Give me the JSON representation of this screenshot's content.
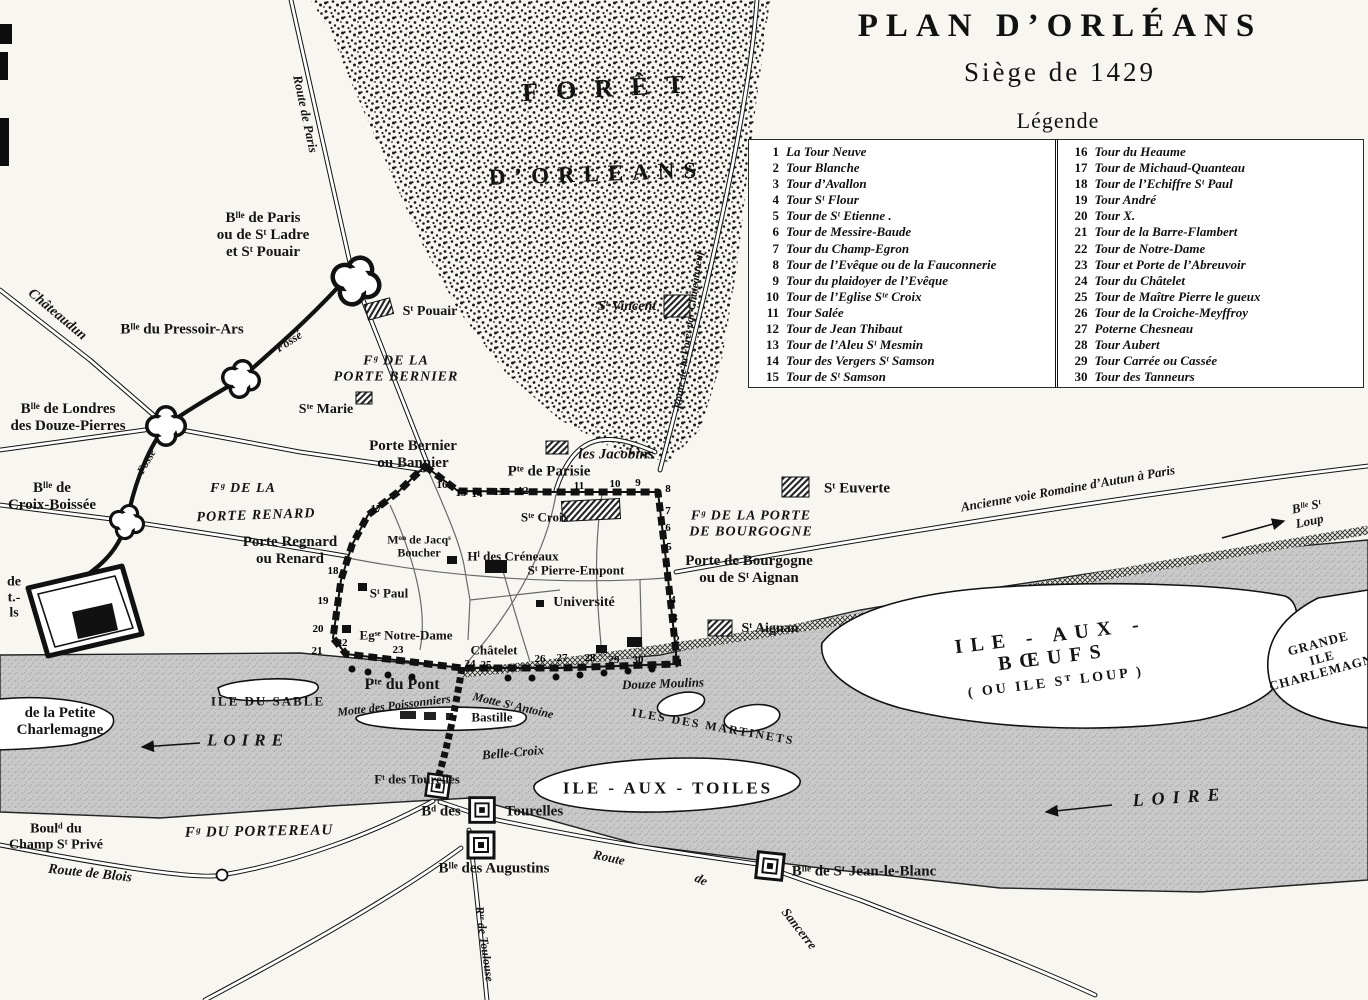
{
  "title": {
    "line1": "PLAN D’ORLÉANS",
    "line2": "Siège  de  1429"
  },
  "legend": {
    "heading": "Légende",
    "items": [
      {
        "n": 1,
        "label": "La Tour Neuve"
      },
      {
        "n": 2,
        "label": "Tour Blanche"
      },
      {
        "n": 3,
        "label": "Tour d’Avallon"
      },
      {
        "n": 4,
        "label": "Tour Sᵗ Flour"
      },
      {
        "n": 5,
        "label": "Tour de Sᵗ Etienne ."
      },
      {
        "n": 6,
        "label": "Tour de Messire-Baude"
      },
      {
        "n": 7,
        "label": "Tour du Champ-Egron"
      },
      {
        "n": 8,
        "label": "Tour de l’Evêque ou de la Fauconnerie"
      },
      {
        "n": 9,
        "label": "Tour du plaidoyer de l’Evêque"
      },
      {
        "n": 10,
        "label": "Tour de l’Eglise Sᵗᵉ Croix"
      },
      {
        "n": 11,
        "label": "Tour Salée"
      },
      {
        "n": 12,
        "label": "Tour de Jean Thibaut"
      },
      {
        "n": 13,
        "label": "Tour de l’Aleu Sᵗ Mesmin"
      },
      {
        "n": 14,
        "label": "Tour des Vergers Sᵗ Samson"
      },
      {
        "n": 15,
        "label": "Tour de Sᵗ Samson"
      },
      {
        "n": 16,
        "label": "Tour du Heaume"
      },
      {
        "n": 17,
        "label": "Tour de Michaud-Quanteau"
      },
      {
        "n": 18,
        "label": "Tour de l’Echiffre Sᵗ Paul"
      },
      {
        "n": 19,
        "label": "Tour André"
      },
      {
        "n": 20,
        "label": "Tour X."
      },
      {
        "n": 21,
        "label": "Tour de la Barre-Flambert"
      },
      {
        "n": 22,
        "label": "Tour de Notre-Dame"
      },
      {
        "n": 23,
        "label": "Tour et Porte de l’Abreuvoir"
      },
      {
        "n": 24,
        "label": "Tour du Châtelet"
      },
      {
        "n": 25,
        "label": "Tour de Maître Pierre le gueux"
      },
      {
        "n": 26,
        "label": "Tour de la Croiche-Meyffroy"
      },
      {
        "n": 27,
        "label": "Poterne Chesneau"
      },
      {
        "n": 28,
        "label": "Tour Aubert"
      },
      {
        "n": 29,
        "label": "Tour Carrée ou Cassée"
      },
      {
        "n": 30,
        "label": "Tour des Tanneurs"
      }
    ]
  },
  "map": {
    "labels": [
      {
        "name": "foret-label-1",
        "text": "FORÊT",
        "x": 612,
        "y": 88,
        "rot": -3,
        "cls": "caps",
        "fs": 26,
        "ls": 18
      },
      {
        "name": "foret-label-2",
        "text": "D’ORLÉANS",
        "x": 597,
        "y": 174,
        "rot": -2,
        "cls": "caps",
        "fs": 23,
        "ls": 9
      },
      {
        "name": "route-de-paris-label",
        "text": "Route de Paris",
        "x": 305,
        "y": 114,
        "rot": 78,
        "cls": "it",
        "fs": 13
      },
      {
        "name": "blle-de-paris-label",
        "text": "Bˡˡᵉ de Paris\nou de Sᵗ Ladre\net Sᵗ Pouair",
        "x": 263,
        "y": 235,
        "fs": 15
      },
      {
        "name": "chateaudun-label",
        "text": "Châteaudun",
        "x": 57,
        "y": 315,
        "rot": 40,
        "cls": "it",
        "fs": 14
      },
      {
        "name": "blle-pressoir-ars-label",
        "text": "Bˡˡᵉ du Pressoir-Ars",
        "x": 182,
        "y": 330,
        "fs": 15
      },
      {
        "name": "fosse-label-1",
        "text": "Fossé",
        "x": 289,
        "y": 342,
        "rot": -33,
        "cls": "it",
        "fs": 12
      },
      {
        "name": "fg-porte-bernier-label",
        "text": "Fᵍ DE LA\nPORTE BERNIER",
        "x": 396,
        "y": 369,
        "cls": "itcaps",
        "fs": 14
      },
      {
        "name": "st-pouair-label",
        "text": "Sᵗ Pouair",
        "x": 430,
        "y": 312,
        "fs": 14
      },
      {
        "name": "ste-marie-label",
        "text": "Sᵗᵉ Marie",
        "x": 326,
        "y": 410,
        "fs": 14
      },
      {
        "name": "blle-londres-label",
        "text": "Bˡˡᵉ de Londres\ndes Douze-Pierres",
        "x": 68,
        "y": 418,
        "fs": 15
      },
      {
        "name": "fosse-label-2",
        "text": "Fossé",
        "x": 147,
        "y": 462,
        "rot": -60,
        "cls": "it",
        "fs": 11
      },
      {
        "name": "blle-croix-boissee-label",
        "text": "Bˡˡᵉ de\nCroix-Boissée",
        "x": 52,
        "y": 497,
        "fs": 15
      },
      {
        "name": "fg-de-la-renard-label",
        "text": "Fᵍ DE LA",
        "x": 243,
        "y": 489,
        "cls": "itcaps",
        "fs": 14
      },
      {
        "name": "porte-renard-caps-label",
        "text": "PORTE RENARD",
        "x": 256,
        "y": 516,
        "rot": -2,
        "cls": "itcaps",
        "fs": 14
      },
      {
        "name": "porte-regnard-label",
        "text": "Porte Regnard\nou Renard",
        "x": 290,
        "y": 551,
        "fs": 15
      },
      {
        "name": "left-edge-fragment",
        "text": "de\nt.-\nls",
        "x": 14,
        "y": 598,
        "fs": 14
      },
      {
        "name": "porte-bernier-label",
        "text": "Porte Bernier\nou Bannier",
        "x": 413,
        "y": 455,
        "fs": 15
      },
      {
        "name": "pte-parisie-label",
        "text": "Pᵗᵉ de Parisie",
        "x": 549,
        "y": 472,
        "fs": 15
      },
      {
        "name": "les-jacobins-label",
        "text": "les Jacobins",
        "x": 616,
        "y": 455,
        "cls": "it",
        "fs": 15
      },
      {
        "name": "st-euverte-label",
        "text": "Sᵗ Euverte",
        "x": 857,
        "y": 489,
        "fs": 15
      },
      {
        "name": "ste-croix-label",
        "text": "Sᵗᵉ Croix",
        "x": 545,
        "y": 518,
        "fs": 13
      },
      {
        "name": "mon-jacq-boucher-label",
        "text": "Mᵒⁿ de Jacqˢ\nBoucher",
        "x": 419,
        "y": 547,
        "fs": 12
      },
      {
        "name": "hl-des-creneaux-label",
        "text": "Hˡ des Créneaux",
        "x": 513,
        "y": 557,
        "fs": 13
      },
      {
        "name": "st-pierre-empont-label",
        "text": "Sᵗ Pierre-Empont",
        "x": 576,
        "y": 571,
        "fs": 13
      },
      {
        "name": "st-paul-label",
        "text": "Sᵗ Paul",
        "x": 389,
        "y": 594,
        "fs": 13
      },
      {
        "name": "universite-label",
        "text": "Université",
        "x": 584,
        "y": 603,
        "fs": 14
      },
      {
        "name": "egse-notre-dame-label",
        "text": "Egˢᵉ Notre-Dame",
        "x": 406,
        "y": 636,
        "fs": 13
      },
      {
        "name": "chatelet-label",
        "text": "Châtelet",
        "x": 494,
        "y": 651,
        "fs": 13
      },
      {
        "name": "fg-porte-bourgogne-label",
        "text": "Fᵍ DE LA PORTE\nDE BOURGOGNE",
        "x": 751,
        "y": 524,
        "cls": "itcaps",
        "fs": 14
      },
      {
        "name": "porte-bourgogne-label",
        "text": "Porte de Bourgogne\nou de Sᵗ Aignan",
        "x": 749,
        "y": 570,
        "fs": 15
      },
      {
        "name": "st-aignan-label",
        "text": "Sᵗ Aignan",
        "x": 770,
        "y": 629,
        "fs": 14
      },
      {
        "name": "voie-romaine-label",
        "text": "Ancienne voie Romaine d’Autun à Paris",
        "x": 1068,
        "y": 489,
        "rot": -10,
        "cls": "it",
        "fs": 13
      },
      {
        "name": "blle-st-loup-label",
        "text": "Bˡˡᵉ Sᵗ Loup",
        "x": 1308,
        "y": 514,
        "rot": -12,
        "cls": "it",
        "fs": 13
      },
      {
        "name": "st-vincent-label",
        "text": "Sᵗ Vincent",
        "x": 627,
        "y": 307,
        "cls": "it",
        "fs": 14
      },
      {
        "name": "route-foret-label",
        "text": "Route de la Forêt par Châteauneuf",
        "x": 689,
        "y": 330,
        "rot": -82,
        "cls": "it",
        "fs": 11
      },
      {
        "name": "pte-du-pont-label",
        "text": "Pᵗᵉ du Pont",
        "x": 402,
        "y": 685,
        "fs": 16
      },
      {
        "name": "motte-poissonniers-label",
        "text": "Motte des Poissonniers",
        "x": 394,
        "y": 706,
        "rot": -7,
        "cls": "it",
        "fs": 12
      },
      {
        "name": "motte-st-antoine-label",
        "text": "Motte Sᵗ Antoine",
        "x": 513,
        "y": 706,
        "rot": 13,
        "cls": "it",
        "fs": 12
      },
      {
        "name": "bastille-label",
        "text": "Bastille",
        "x": 492,
        "y": 718,
        "fs": 13
      },
      {
        "name": "belle-croix-label",
        "text": "Belle-Croix",
        "x": 513,
        "y": 753,
        "rot": -5,
        "cls": "it",
        "fs": 13
      },
      {
        "name": "ft-des-tourelles-label",
        "text": "Fᵗ des Tourelles",
        "x": 417,
        "y": 780,
        "fs": 13
      },
      {
        "name": "bd-des-label",
        "text": "Bᵈ des",
        "x": 441,
        "y": 812,
        "fs": 15
      },
      {
        "name": "tourelles-label",
        "text": "Tourelles",
        "x": 534,
        "y": 812,
        "fs": 15
      },
      {
        "name": "blle-augustins-label",
        "text": "Bˡˡᵉ des Augustins",
        "x": 494,
        "y": 869,
        "fs": 15
      },
      {
        "name": "douze-moulins-label",
        "text": "Douze Moulins",
        "x": 663,
        "y": 684,
        "rot": -2,
        "cls": "it",
        "fs": 13
      },
      {
        "name": "ile-du-sable-label",
        "text": "ILE DU SABLE",
        "x": 268,
        "y": 702,
        "cls": "caps",
        "fs": 13,
        "ls": 2
      },
      {
        "name": "loire-left-label",
        "text": "LOIRE",
        "x": 248,
        "y": 740,
        "cls": "it",
        "fs": 17,
        "ls": 6
      },
      {
        "name": "petite-charlemagne-label",
        "text": "de la Petite\nCharlemagne",
        "x": 60,
        "y": 722,
        "fs": 15
      },
      {
        "name": "iles-martinets-label",
        "text": "ILES DES MARTINETS",
        "x": 713,
        "y": 727,
        "rot": 10,
        "cls": "caps",
        "fs": 12,
        "ls": 2
      },
      {
        "name": "ile-aux-toiles-label",
        "text": "ILE - AUX - TOILES",
        "x": 668,
        "y": 788,
        "cls": "caps",
        "fs": 17,
        "ls": 3
      },
      {
        "name": "ile-aux-boeufs-label",
        "text": "ILE - AUX - BŒUFS",
        "x": 1052,
        "y": 647,
        "rot": -7,
        "cls": "caps",
        "fs": 20,
        "ls": 8
      },
      {
        "name": "ou-ile-st-loup-label",
        "text": "( OU ILE Sᵀ LOUP )",
        "x": 1056,
        "y": 683,
        "rot": -7,
        "cls": "caps",
        "fs": 14,
        "ls": 3
      },
      {
        "name": "grande-ile-label",
        "text": "GRANDE\nILE\nCHARLEMAGNE",
        "x": 1322,
        "y": 658,
        "rot": -15,
        "cls": "caps",
        "fs": 13,
        "ls": 1
      },
      {
        "name": "loire-right-label",
        "text": "LOIRE",
        "x": 1180,
        "y": 797,
        "rot": -4,
        "cls": "it",
        "fs": 18,
        "ls": 8
      },
      {
        "name": "route-sancerre-label-1",
        "text": "Route",
        "x": 609,
        "y": 858,
        "rot": 12,
        "cls": "it",
        "fs": 13
      },
      {
        "name": "route-sancerre-label-2",
        "text": "de",
        "x": 701,
        "y": 880,
        "rot": 25,
        "cls": "it",
        "fs": 13
      },
      {
        "name": "route-sancerre-label-3",
        "text": "Sancerre",
        "x": 799,
        "y": 929,
        "rot": 52,
        "cls": "it",
        "fs": 13
      },
      {
        "name": "blle-st-jean-label",
        "text": "Bˡˡᵉ de Sᵗ Jean-le-Blanc",
        "x": 864,
        "y": 872,
        "fs": 15
      },
      {
        "name": "rte-toulouse-label",
        "text": "Rᵗᵉ de Toulouse",
        "x": 484,
        "y": 944,
        "rot": 82,
        "cls": "it",
        "fs": 12
      },
      {
        "name": "fg-portereau-label",
        "text": "Fᵍ DU PORTEREAU",
        "x": 259,
        "y": 832,
        "rot": -1,
        "cls": "itcaps",
        "fs": 15
      },
      {
        "name": "bould-champ-st-prive-label",
        "text": "Boulᵈ du\nChamp Sᵗ Privé",
        "x": 56,
        "y": 837,
        "fs": 14
      },
      {
        "name": "route-de-blois-label",
        "text": "Route de Blois",
        "x": 90,
        "y": 874,
        "rot": 6,
        "cls": "it",
        "fs": 14
      }
    ],
    "wall_numbers": [
      {
        "n": "16",
        "x": 442,
        "y": 485
      },
      {
        "n": "15",
        "x": 461,
        "y": 493
      },
      {
        "n": "14",
        "x": 477,
        "y": 494
      },
      {
        "n": "13",
        "x": 499,
        "y": 492
      },
      {
        "n": "12",
        "x": 523,
        "y": 491
      },
      {
        "n": "11",
        "x": 579,
        "y": 486
      },
      {
        "n": "10",
        "x": 615,
        "y": 484
      },
      {
        "n": "9",
        "x": 638,
        "y": 483
      },
      {
        "n": "17",
        "x": 376,
        "y": 509
      },
      {
        "n": "18",
        "x": 333,
        "y": 571
      },
      {
        "n": "19",
        "x": 323,
        "y": 601
      },
      {
        "n": "20",
        "x": 318,
        "y": 629
      },
      {
        "n": "21",
        "x": 317,
        "y": 651
      },
      {
        "n": "22",
        "x": 342,
        "y": 643
      },
      {
        "n": "23",
        "x": 398,
        "y": 650
      },
      {
        "n": "24",
        "x": 470,
        "y": 664
      },
      {
        "n": "25",
        "x": 486,
        "y": 665
      },
      {
        "n": "26",
        "x": 540,
        "y": 659
      },
      {
        "n": "27",
        "x": 562,
        "y": 658
      },
      {
        "n": "28",
        "x": 590,
        "y": 658
      },
      {
        "n": "29",
        "x": 614,
        "y": 660
      },
      {
        "n": "30",
        "x": 638,
        "y": 660
      },
      {
        "n": "8",
        "x": 668,
        "y": 489
      },
      {
        "n": "7",
        "x": 668,
        "y": 511
      },
      {
        "n": "6",
        "x": 668,
        "y": 528
      },
      {
        "n": "5",
        "x": 669,
        "y": 547
      },
      {
        "n": "4",
        "x": 673,
        "y": 600
      },
      {
        "n": "3",
        "x": 675,
        "y": 618
      },
      {
        "n": "2",
        "x": 677,
        "y": 640
      },
      {
        "n": "1",
        "x": 680,
        "y": 663
      }
    ]
  }
}
